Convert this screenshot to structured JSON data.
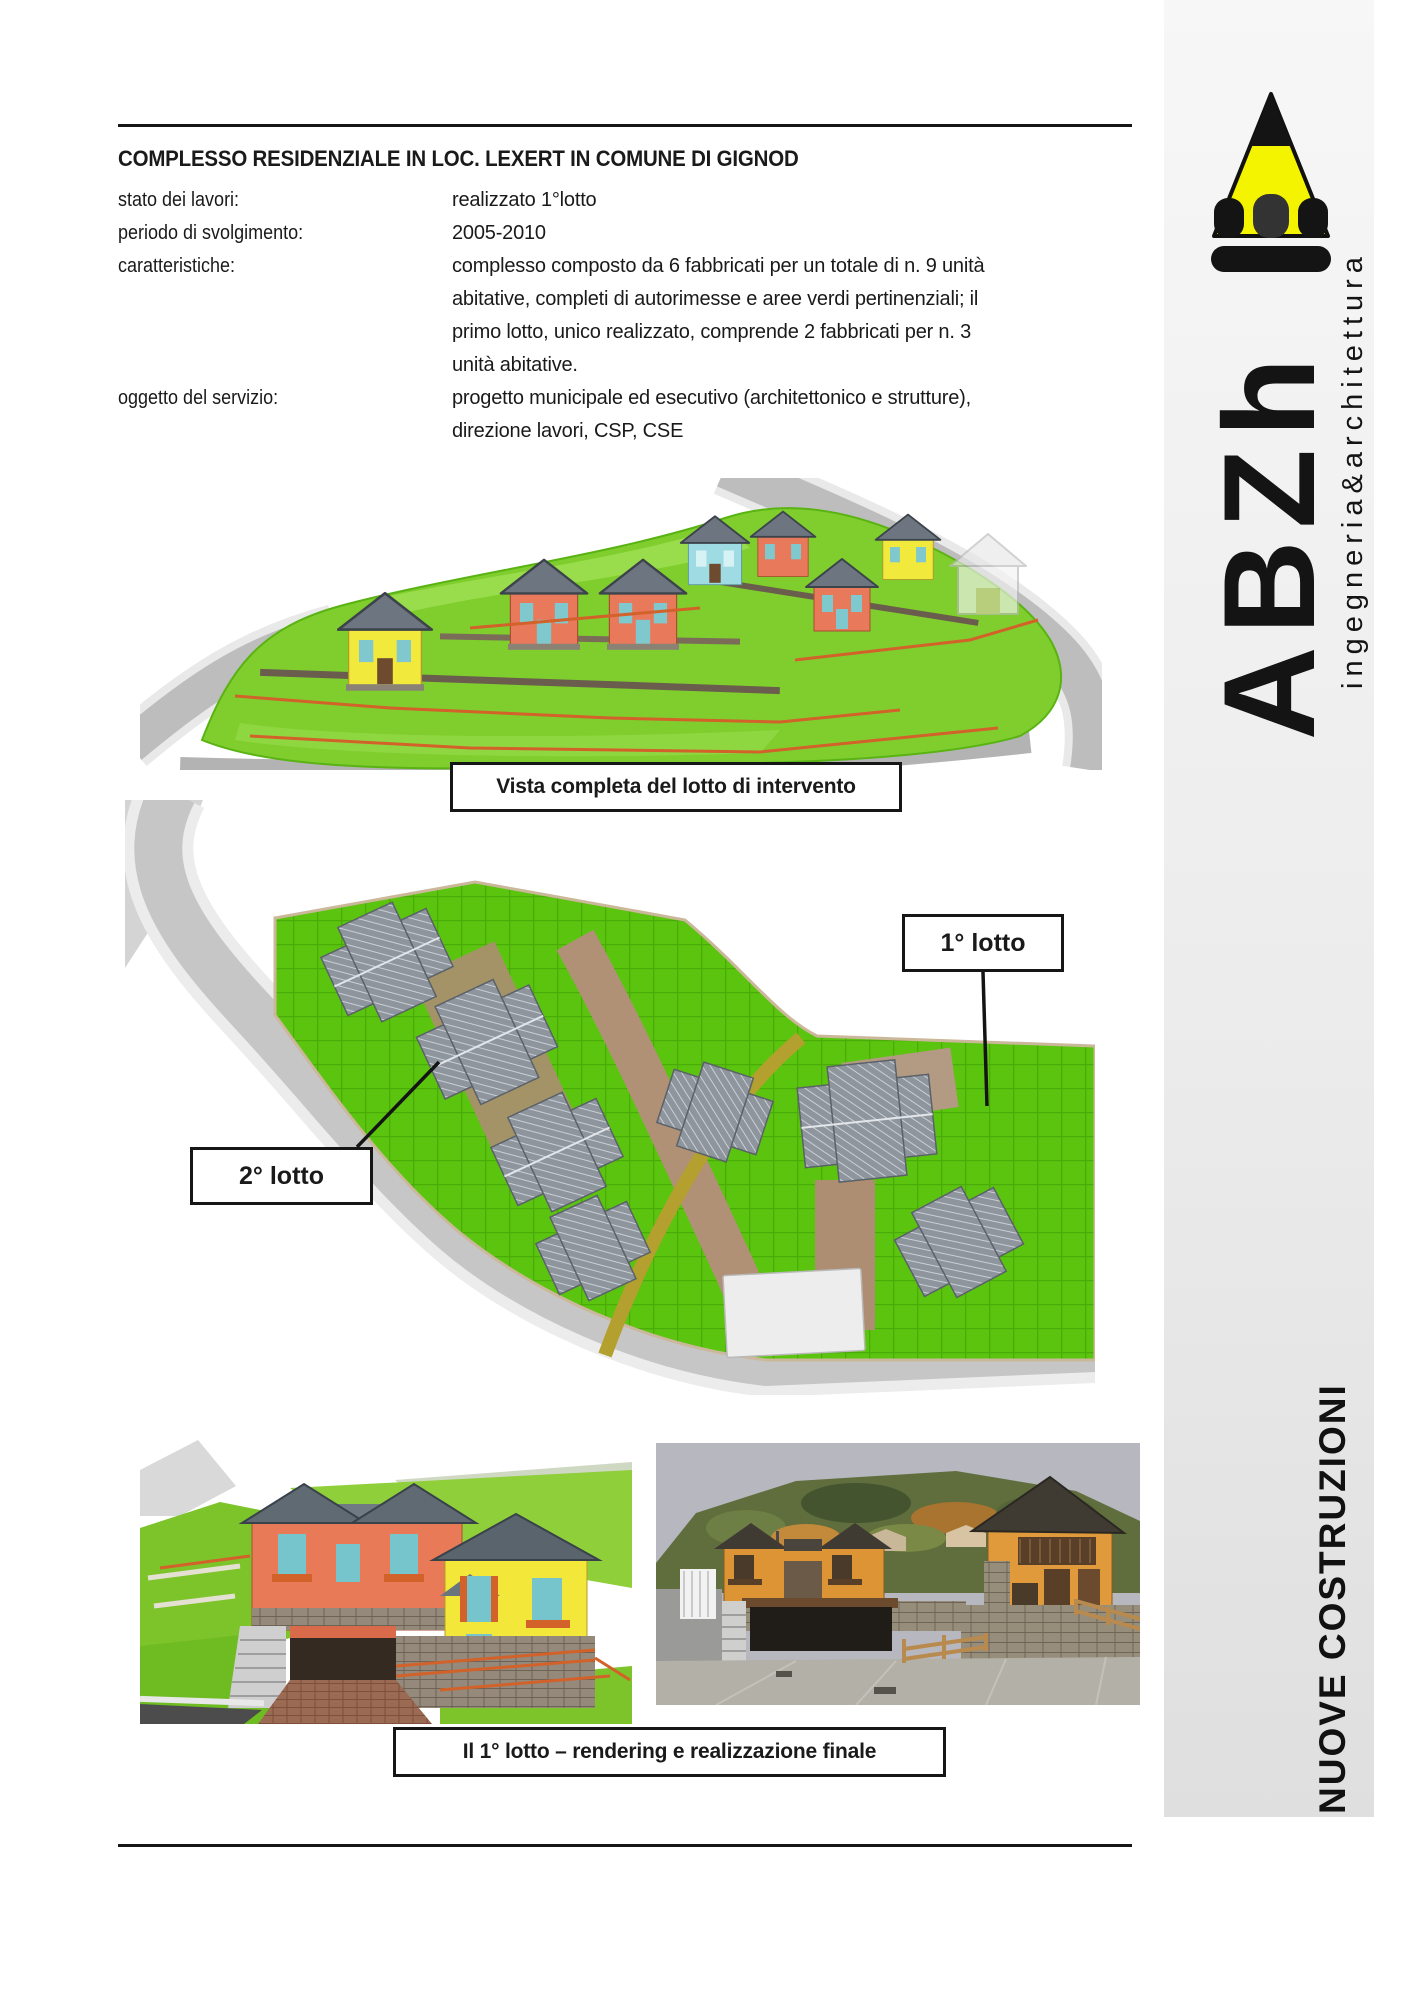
{
  "page": {
    "title": "COMPLESSO RESIDENZIALE IN LOC. LEXERT IN COMUNE DI GIGNOD",
    "info": [
      {
        "label": "stato dei lavori:",
        "value": "realizzato 1°lotto"
      },
      {
        "label": "periodo di svolgimento:",
        "value": "2005-2010"
      },
      {
        "label": "caratteristiche:",
        "value": "complesso composto da 6 fabbricati per un totale di n. 9 unità abitative, completi di autorimesse e aree verdi pertinenziali; il primo lotto, unico realizzato, comprende 2 fabbricati per n. 3 unità abitative."
      },
      {
        "label": "oggetto del servizio:",
        "value": "progetto municipale ed esecutivo (architettonico e strutture), direzione lavori, CSP, CSE"
      }
    ],
    "captions": {
      "overview": "Vista completa del lotto di intervento",
      "first_lot": "Il 1° lotto – rendering e realizzazione finale"
    },
    "plan": {
      "lot1_label": "1° lotto",
      "lot2_label": "2° lotto"
    }
  },
  "sidebar": {
    "logo_letters": "ABZh",
    "tagline": "ingegneria&architettura",
    "footer": "NUOVE COSTRUZIONI"
  },
  "palette": {
    "pencil_yellow": "#f4f400",
    "grass_green": "#5bc40e",
    "house_yellow": "#f2e93d",
    "house_salmon": "#e8795a",
    "house_blue": "#9fdbe3",
    "house_orange": "#df9636",
    "roof_gray": "#8e959d",
    "fence_orange": "#d2622a"
  }
}
